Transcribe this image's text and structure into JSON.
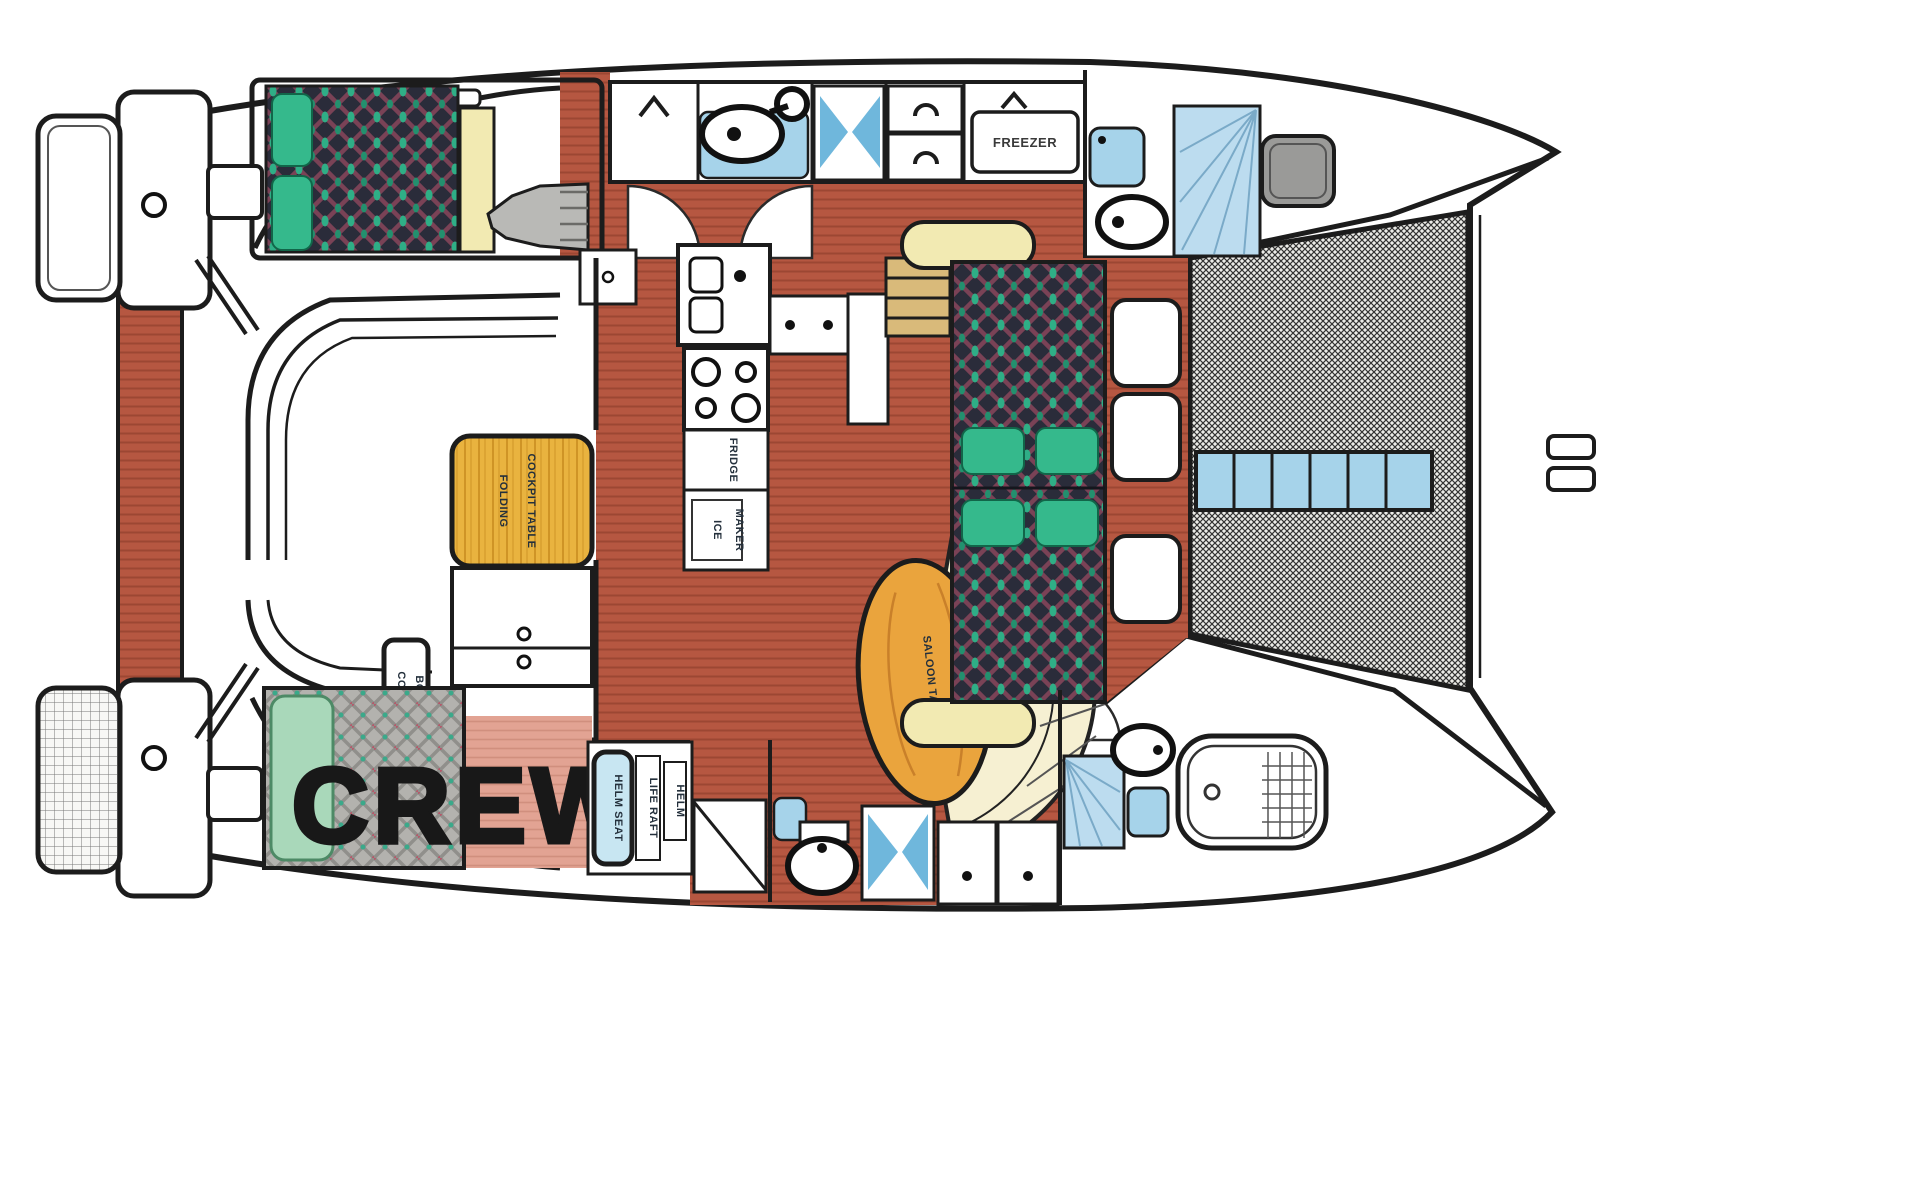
{
  "diagram": {
    "kind": "catamaran interior floor plan, top view, bows to the right"
  },
  "labels": {
    "crew": "CREW",
    "freezer": "FREEZER",
    "fridge": "FRIDGE",
    "ice_maker_line1": "ICE",
    "ice_maker_line2": "MAKER",
    "cockpit_table_line1": "FOLDING",
    "cockpit_table_line2": "COCKPIT TABLE",
    "cold_box_line1": "COLD",
    "cold_box_line2": "BOX",
    "helm_seat": "HELM SEAT",
    "life_raft": "LIFE RAFT",
    "helm": "HELM",
    "saloon_table": "SALOON TABLE"
  },
  "colors": {
    "outline": "#1c1c1c",
    "floor_wood": "#b65741",
    "bed_dark": "#2a2c3a",
    "pillow_green": "#35b98c",
    "pillow_mint": "#a9d8ba",
    "fixture_blue": "#a6d3ea",
    "shower_blue": "#bcdcef",
    "shower_tri_blue": "#6fb7dc",
    "table_wood": "#e9b33f",
    "saloon_table_wood": "#eaa43d",
    "settee_cream": "#f6f0d2",
    "shelf_yellow": "#f2eab2",
    "steps_tan": "#d9ba7a",
    "salmon_floor": "#e2a393",
    "life_raft_red": "#c03030",
    "helm_text_navy": "#1a2a4a",
    "hatch_gray": "#9a9a98"
  }
}
